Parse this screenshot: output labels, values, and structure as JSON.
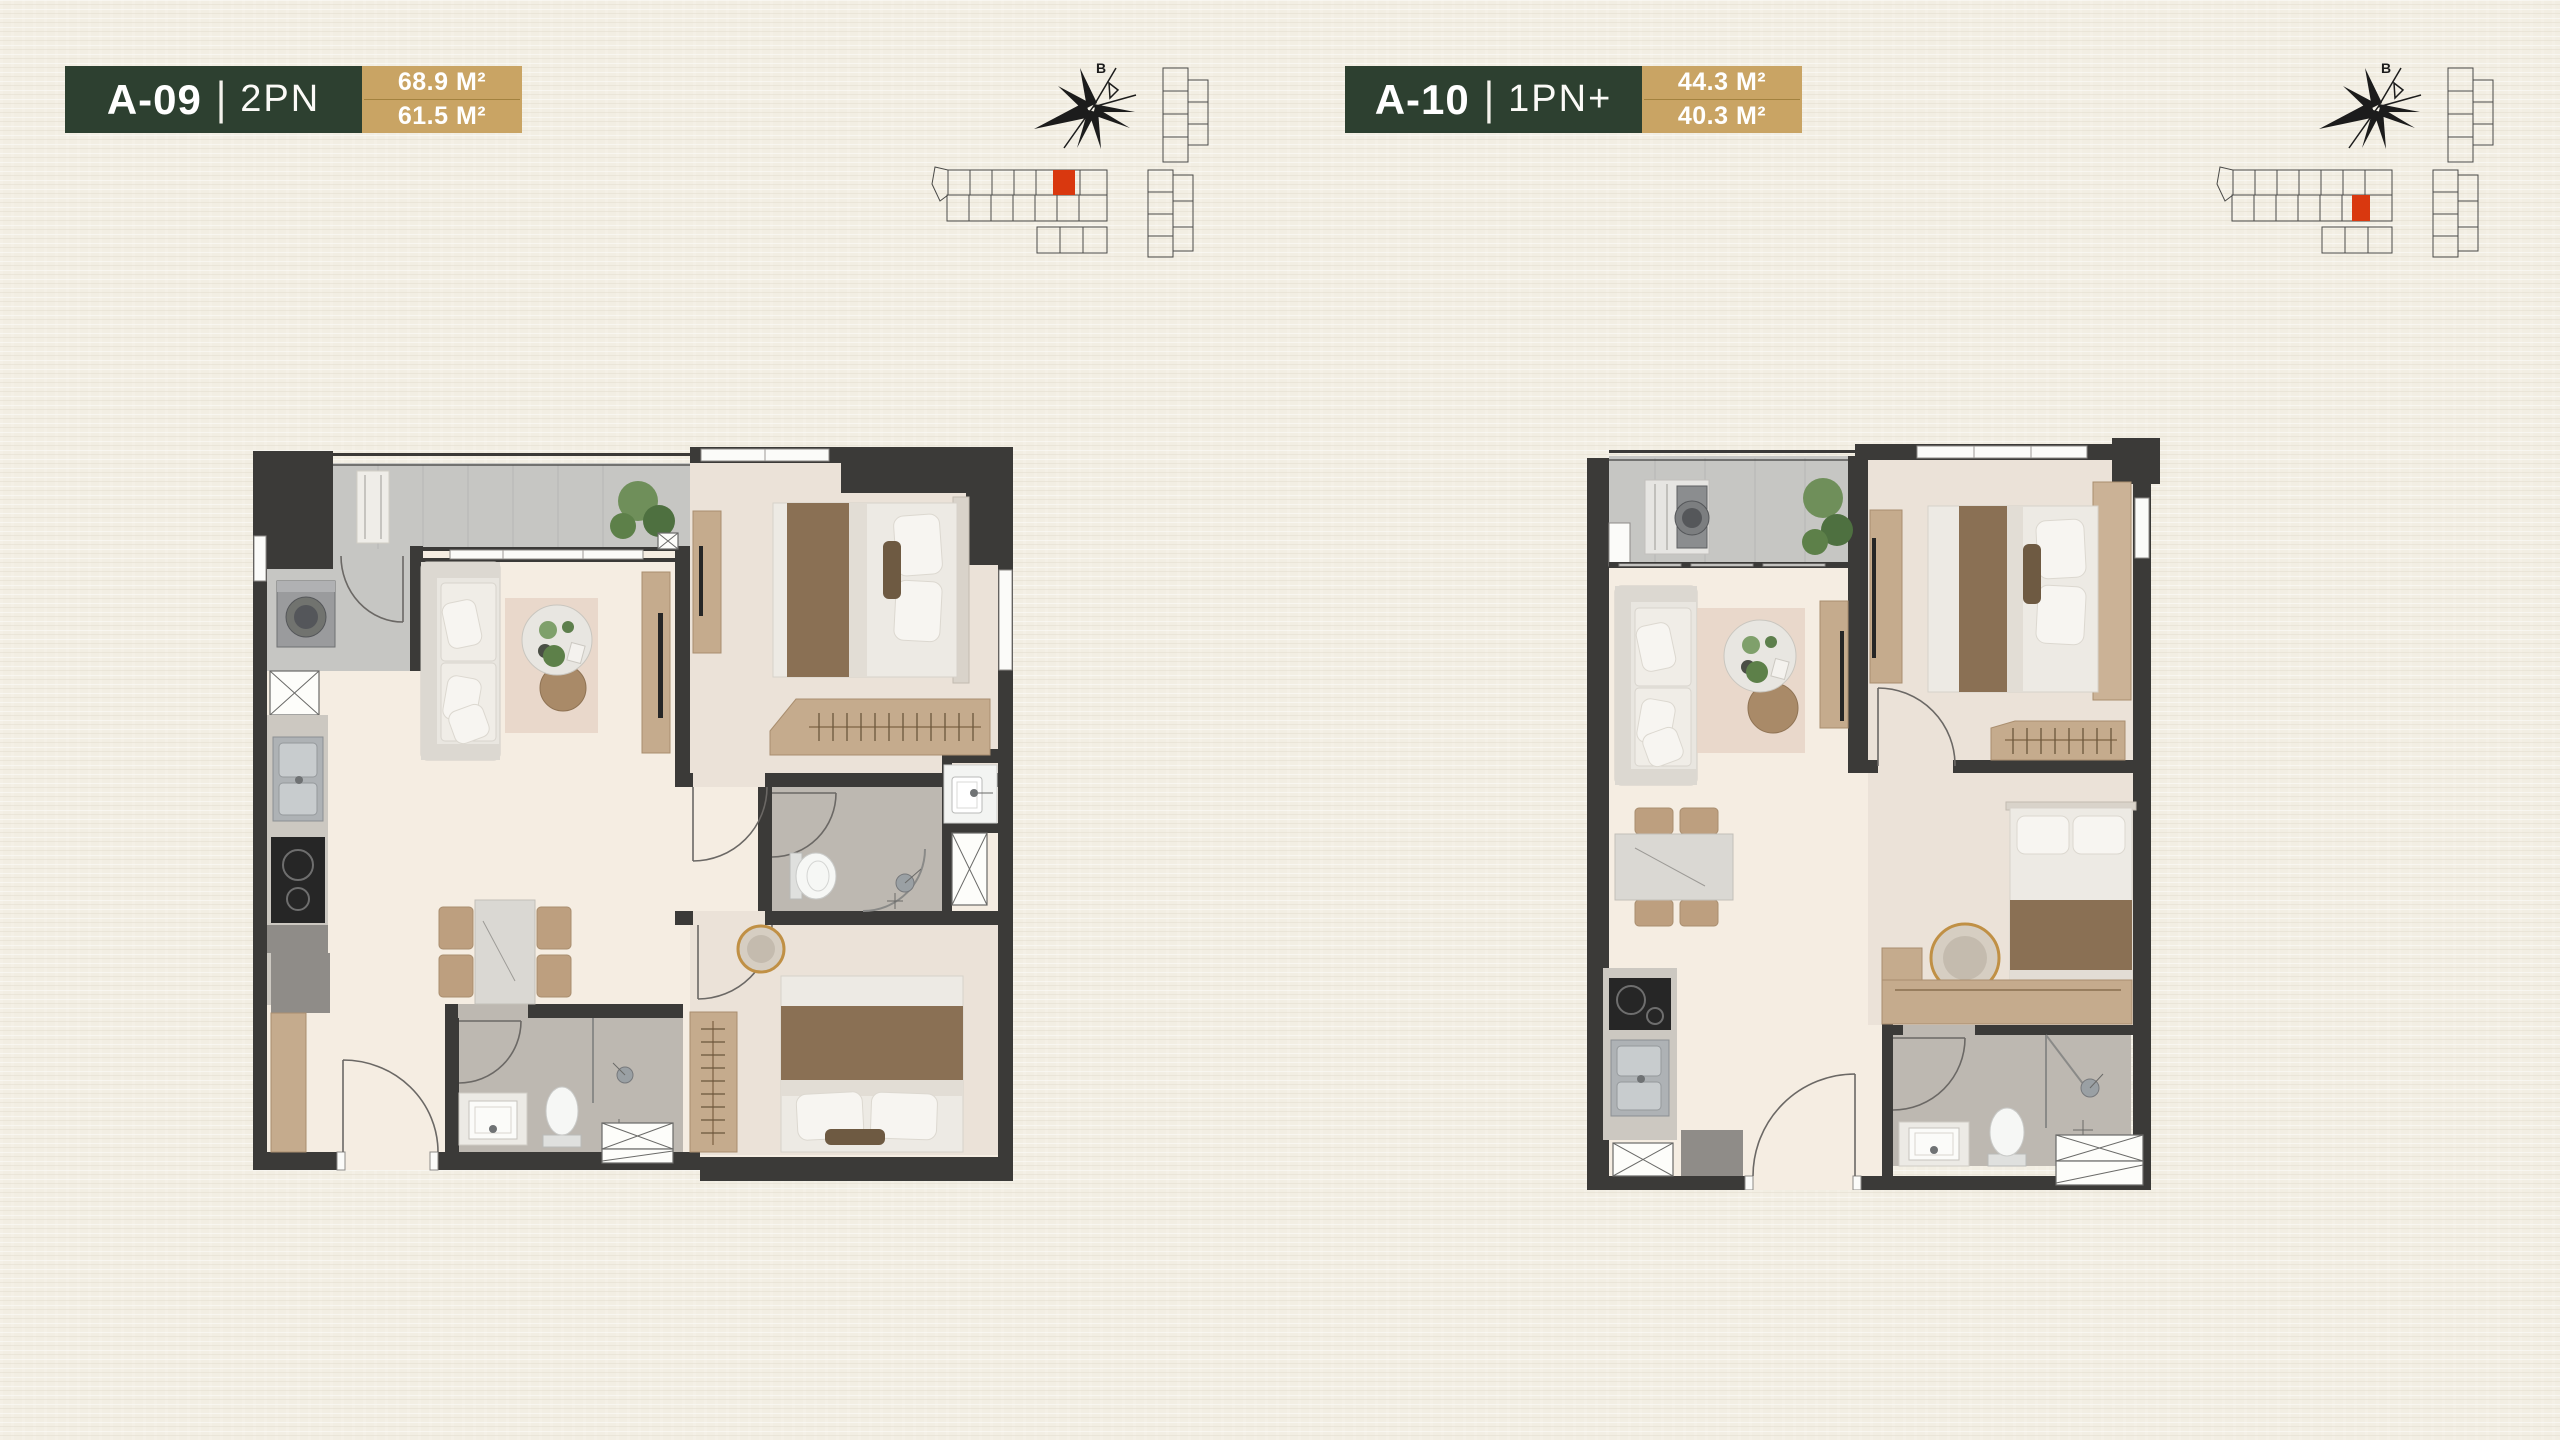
{
  "units": [
    {
      "code": "A-09",
      "divider": "|",
      "type": "2PN",
      "area_gross": "68.9 M²",
      "area_net": "61.5 M²",
      "compass_label": "B"
    },
    {
      "code": "A-10",
      "divider": "|",
      "type": "1PN+",
      "area_gross": "44.3 M²",
      "area_net": "40.3 M²",
      "compass_label": "B"
    }
  ],
  "colors": {
    "background": "#f2eee3",
    "badge_green": "#2d4030",
    "badge_tan": "#c9a464",
    "area_divider_line": "#a3823f",
    "highlight_red": "#d9380f",
    "wall": "#3b3a38"
  }
}
